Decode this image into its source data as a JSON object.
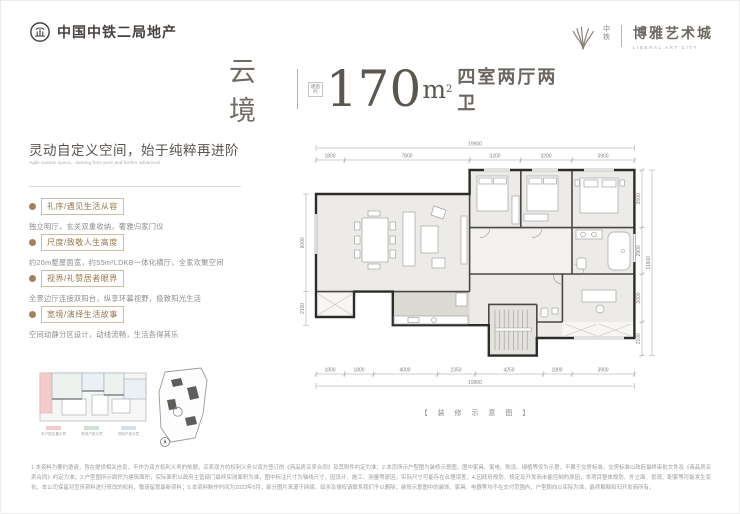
{
  "header": {
    "left_logo": {
      "text": "中国中铁二局地产"
    },
    "right_logo": {
      "prefix": "中铁",
      "name": "博雅艺术城",
      "subtitle": "LIBERAL ART CITY"
    }
  },
  "title": {
    "name": "云境",
    "area_prefix": "建面约",
    "area_value": "170",
    "area_unit": "m",
    "area_sup": "2",
    "layout": "四室两厅两卫"
  },
  "intro": {
    "heading": "灵动自定义空间，始于纯粹再进阶",
    "subheading": "Agile custom space，starting from pure and further advanced",
    "accent_color": "#a5805a",
    "features": [
      {
        "label": "礼序/遇见生活从容",
        "desc": "独立明厅，玄关双重收纳，奢雅归家门仪"
      },
      {
        "label": "尺度/致敬人生高度",
        "desc": "约20m整屋面宽，约55m²LDKB一体化横厅，全家欢聚空间"
      },
      {
        "label": "视界/礼赞居者眼界",
        "desc": "全景边厅连接双阳台，纵享环幕视野，极致阳光生活"
      },
      {
        "label": "宽境/演绎生活故事",
        "desc": "空间动静分区设计，动线流畅，生活各得其乐"
      }
    ]
  },
  "keyplan": {
    "legend": [
      {
        "color": "#f2cbca",
        "label": "本户型位置示意"
      },
      {
        "color": "#cfe0d5",
        "label": "其他户型示意"
      },
      {
        "color": "#cfe0ef",
        "label": "其他户型示意"
      }
    ]
  },
  "floorplan": {
    "caption": "【 装 修 示 意 图 】",
    "dims_top_total": "19900",
    "dims_top": [
      "1800",
      "7800",
      "3200",
      "3200",
      "3900"
    ],
    "dims_bottom": [
      "1800",
      "1800",
      "4000",
      "2350",
      "4250",
      "1800",
      "3900"
    ],
    "dims_bottom_total": "19900",
    "dims_left": [
      "6000",
      "2100"
    ],
    "dims_right": [
      "3600",
      "2900",
      "3000",
      "2100"
    ],
    "dims_right_total": "11600"
  },
  "disclaimer": "1.本资料为要约邀请，旨在提供相关信息，不作为双方权利义务的依据，买卖双方的权利义务以双方签订的《商品房买卖合同》及其附件约定为准；2.本页所示户型图为装修示意图，图中家具、家电、陈设、绿植等仅为示意，不属于交房标准，交房标准以政府最终审批文件及《商品房买卖合同》约定为准；3.户型图所示面积为建筑面积，实际面积以政府主管部门最终实测面积为准，图中标注尺寸为轴线尺寸，因设计、施工、测量等原因，实际尺寸可能存在合理误差；4.因政府规划、规定及开发商未能控制的原因，本项目整体规划、外立面、景观、配套等可能发生变化，本公司保留对宣传资料进行修改的权利，敬请留意最新资料；5.本资料制作时间为2023年5月，部分图片来源于网络，如涉及侵权请联系我们予以删除；装修示意图中的装饰、家具、电器等均不在交付范围内，户型朝向以实际为准，最终解释权归开发商所有。"
}
